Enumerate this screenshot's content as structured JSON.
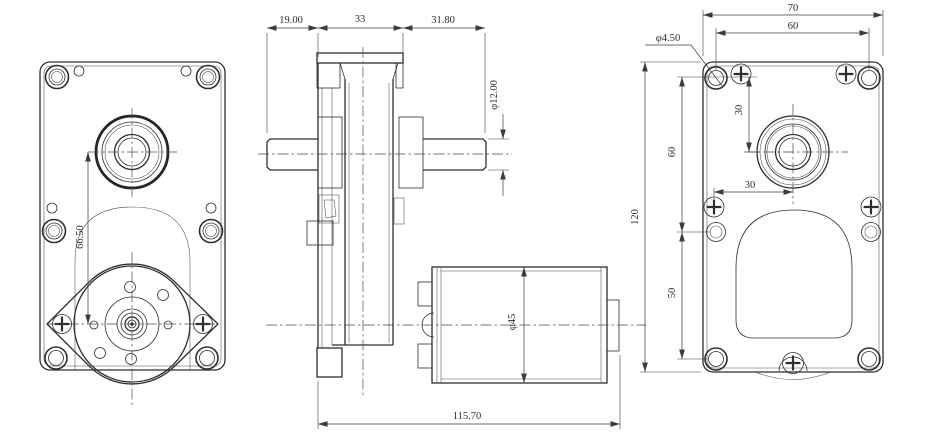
{
  "drawing": {
    "kind": "engineering-drawing",
    "subject": "gear motor, three orthographic views",
    "colors": {
      "background": "#ffffff",
      "line": "#2e2e2e",
      "dimension": "#3c3c3c"
    },
    "views": {
      "front": {
        "label": "front view (output side)",
        "dims": {
          "center_distance": "66.50"
        }
      },
      "side": {
        "label": "side view (section profile with motor)",
        "dims": {
          "left_shaft": "19.00",
          "body_width": "33",
          "right_shaft": "31.80",
          "shaft_dia": "φ12.00",
          "motor_dia": "φ45",
          "overall_length": "115.70"
        }
      },
      "back": {
        "label": "back view (mounting face)",
        "dims": {
          "overall_width": "70",
          "hole_span_h": "60",
          "hole_dia": "φ4.50",
          "offset_top": "30",
          "hole_span_v_upper": "60",
          "overall_height": "120",
          "offset_side": "30",
          "hole_span_v_lower": "50"
        }
      }
    }
  }
}
